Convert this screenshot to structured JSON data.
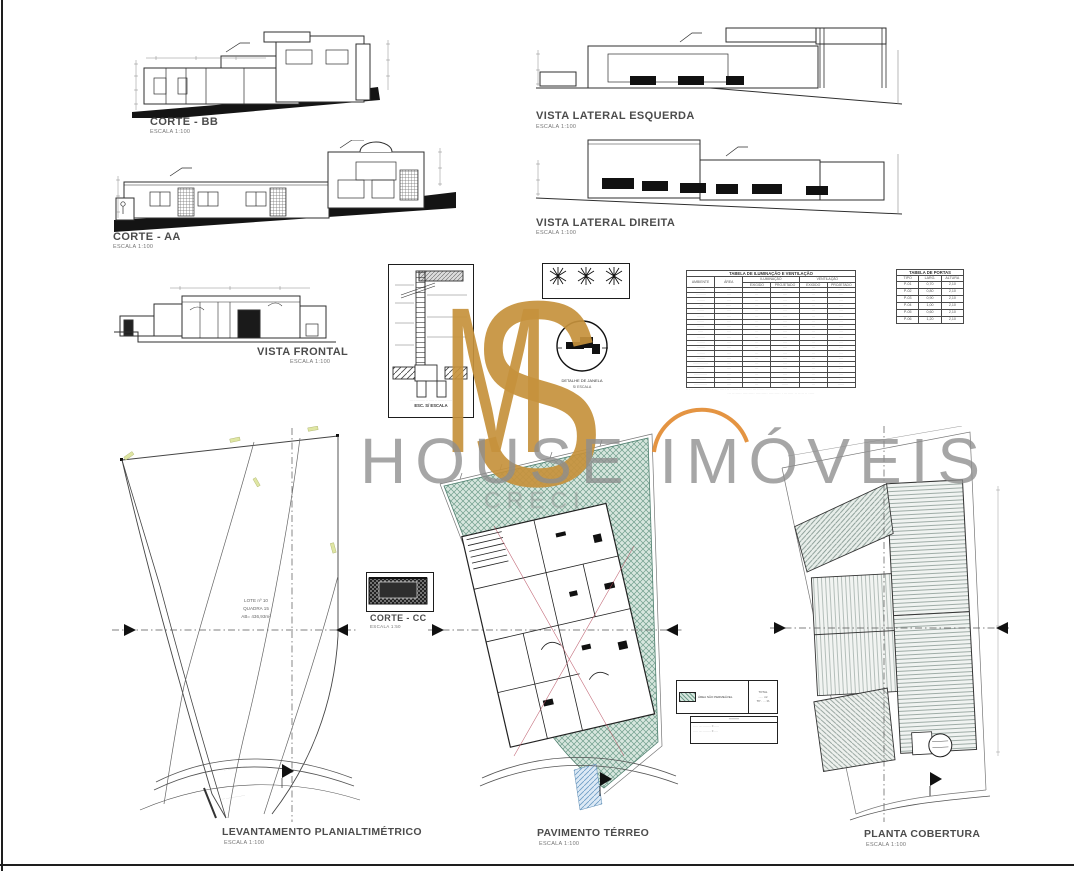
{
  "sheet": {
    "labels": {
      "corte_bb": {
        "title": "CORTE - BB",
        "scale": "ESCALA 1:100"
      },
      "corte_aa": {
        "title": "CORTE - AA",
        "scale": "ESCALA 1:100"
      },
      "vista_lateral_esquerda": {
        "title": "VISTA LATERAL ESQUERDA",
        "scale": "ESCALA 1:100"
      },
      "vista_lateral_direita": {
        "title": "VISTA LATERAL DIREITA",
        "scale": "ESCALA 1:100"
      },
      "vista_frontal": {
        "title": "VISTA FRONTAL",
        "scale": "ESCALA 1:100"
      },
      "corte_cc": {
        "title": "CORTE - CC",
        "scale": "ESCALA 1:50"
      },
      "levantamento": {
        "title": "LEVANTAMENTO PLANIALTIMÉTRICO",
        "scale": "ESCALA 1:100"
      },
      "pavimento_terreo": {
        "title": "PAVIMENTO TÉRREO",
        "scale": "ESCALA 1:100"
      },
      "planta_cobertura": {
        "title": "PLANTA COBERTURA",
        "scale": "ESCALA 1:100"
      }
    },
    "details": {
      "wall_section_caption_small": "··· ·· ········· ·· ····· ·· ······ ·· ·····",
      "wall_section_caption": "ESC. S/ ESCALA",
      "window_detail_line1": "DETALHE DE JANELA",
      "window_detail_line2": "S/ ESCALA",
      "truss_caption1": "·····",
      "truss_caption2": "·····",
      "truss_caption3": "·····"
    },
    "site_info": {
      "lote": "LOTE nº 10",
      "quadra": "QUADRA 15",
      "area": "AB= 436,93m²"
    },
    "street_text1": "··· ········ ···········",
    "street_text2": "··· ········ ···········"
  },
  "watermark": {
    "monogram_m": "M",
    "monogram_s": "S",
    "brand": "HOUSE IMÓVEIS",
    "creci": "CRECI",
    "gold": "#c6923c",
    "gray": "#8e8e8e",
    "orange": "#e1882e"
  },
  "tables": {
    "iluminacao": {
      "title": "TABELA DE ILUMINAÇÃO E VENTILAÇÃO",
      "h_ambiente": "AMBIENTE",
      "h_area": "ÁREA",
      "h_ilum": "ILUMINAÇÃO",
      "h_vent": "VENTILAÇÃO",
      "h_exigido": "EXIGIDO",
      "h_projetado": "PROJETADO",
      "rows": [
        [
          "·········",
          "····",
          "···",
          "······",
          "···",
          "······"
        ],
        [
          "··········",
          "····",
          "···",
          "····",
          "···",
          "····"
        ],
        [
          "········",
          "····",
          "···",
          "····",
          "···",
          "····"
        ],
        [
          "····",
          "·····",
          "···",
          "····",
          "···",
          "····"
        ],
        [
          "·······",
          "····",
          "···",
          "····",
          "···",
          "····"
        ],
        [
          "·······",
          "····",
          "···",
          "····",
          "···",
          "····"
        ],
        [
          "·······",
          "····",
          "···",
          "····",
          "···",
          "····"
        ],
        [
          "·······",
          "····",
          "···",
          "····",
          "···",
          "····"
        ],
        [
          "·····",
          "····",
          "···",
          "····",
          "···",
          "····"
        ],
        [
          "········",
          "····",
          "···",
          "····",
          "···",
          "····"
        ],
        [
          "········",
          "····",
          "···",
          "····",
          "···",
          "····"
        ],
        [
          "········",
          "····",
          "···",
          "····",
          "···",
          "····"
        ],
        [
          "········",
          "····",
          "···",
          "····",
          "···",
          "····"
        ],
        [
          "········",
          "····",
          "···",
          "····",
          "···",
          "····"
        ],
        [
          "···············",
          "····",
          "···",
          "····",
          "···",
          "····"
        ],
        [
          "·······",
          "····",
          "···",
          "····",
          "···",
          "····"
        ],
        [
          "·············",
          "····",
          "···",
          "····",
          "···",
          "····"
        ],
        [
          "··········",
          "····",
          "···",
          "····",
          "···",
          "····"
        ],
        [
          "·············",
          "····",
          "···",
          "······",
          "···",
          "······"
        ]
      ],
      "footnote1": "·· ··· ········ ····· · ···· ····· ·· ·········· ······· ··· ··········· ·····",
      "footnote2": "··· ········ ·········· ·········· ·········· · ········ ·· ····· ·· ·····"
    },
    "portas": {
      "title": "TABELA DE PORTAS",
      "h_tipo": "TIPO",
      "h_larg": "LARG.",
      "h_alt": "ALTURA",
      "rows": [
        [
          "P-01",
          "0,70",
          "2,10"
        ],
        [
          "P-02",
          "0,80",
          "2,10"
        ],
        [
          "P-03",
          "0,90",
          "2,10"
        ],
        [
          "P-04",
          "1,00",
          "2,10"
        ],
        [
          "P-05",
          "0,60",
          "2,10"
        ],
        [
          "P-06",
          "1,20",
          "2,10"
        ]
      ]
    }
  },
  "legend": {
    "permeavel": {
      "swatch_label": "ÁREA NÃO PERMEÁVEL",
      "right_line1": "TOTAL",
      "right_line2": "····· m²",
      "right_line3": "TP · ····%"
    },
    "areas_box": {
      "title": "··········",
      "line1": "····· ···· ········ = ·····",
      "line2": "····· ···· ········ = ····"
    }
  },
  "colors": {
    "line": "#2f2f2f",
    "label": "#4c4c4c",
    "green_fill": "#d7e6de",
    "green_line": "#6f9e8c",
    "roof_line": "#8a9a94",
    "blue_line": "#6d9cc4",
    "ground": "#141414"
  }
}
